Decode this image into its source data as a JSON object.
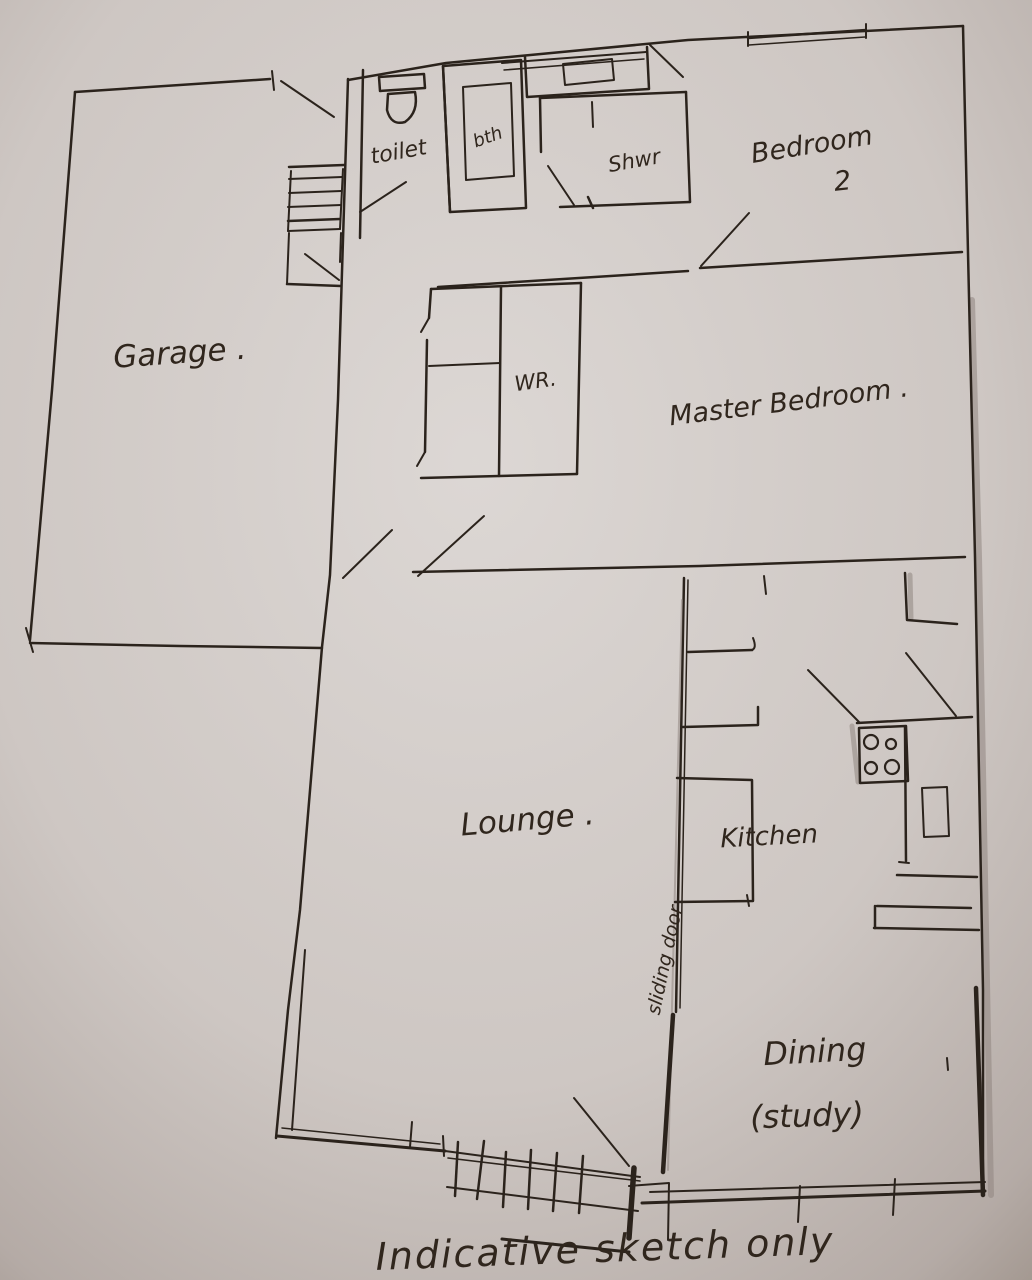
{
  "sketch": {
    "rooms": {
      "garage": {
        "label": "Garage ."
      },
      "toilet": {
        "label": "toilet"
      },
      "bath": {
        "label": "bth"
      },
      "shower": {
        "label": "Shwr"
      },
      "bedroom2": {
        "line1": "Bedroom",
        "line2": "2"
      },
      "wardrobe": {
        "label": "WR."
      },
      "master": {
        "label": "Master Bedroom ."
      },
      "lounge": {
        "label": "Lounge ."
      },
      "kitchen": {
        "label": "Kitchen"
      },
      "dining": {
        "line1": "Dining",
        "line2": "(study)"
      }
    },
    "annotations": {
      "sliding_door": "sliding door",
      "footer_note": "Indicative sketch only"
    },
    "colors": {
      "paper": "#d3cdca",
      "ink": "#2b231c"
    }
  }
}
